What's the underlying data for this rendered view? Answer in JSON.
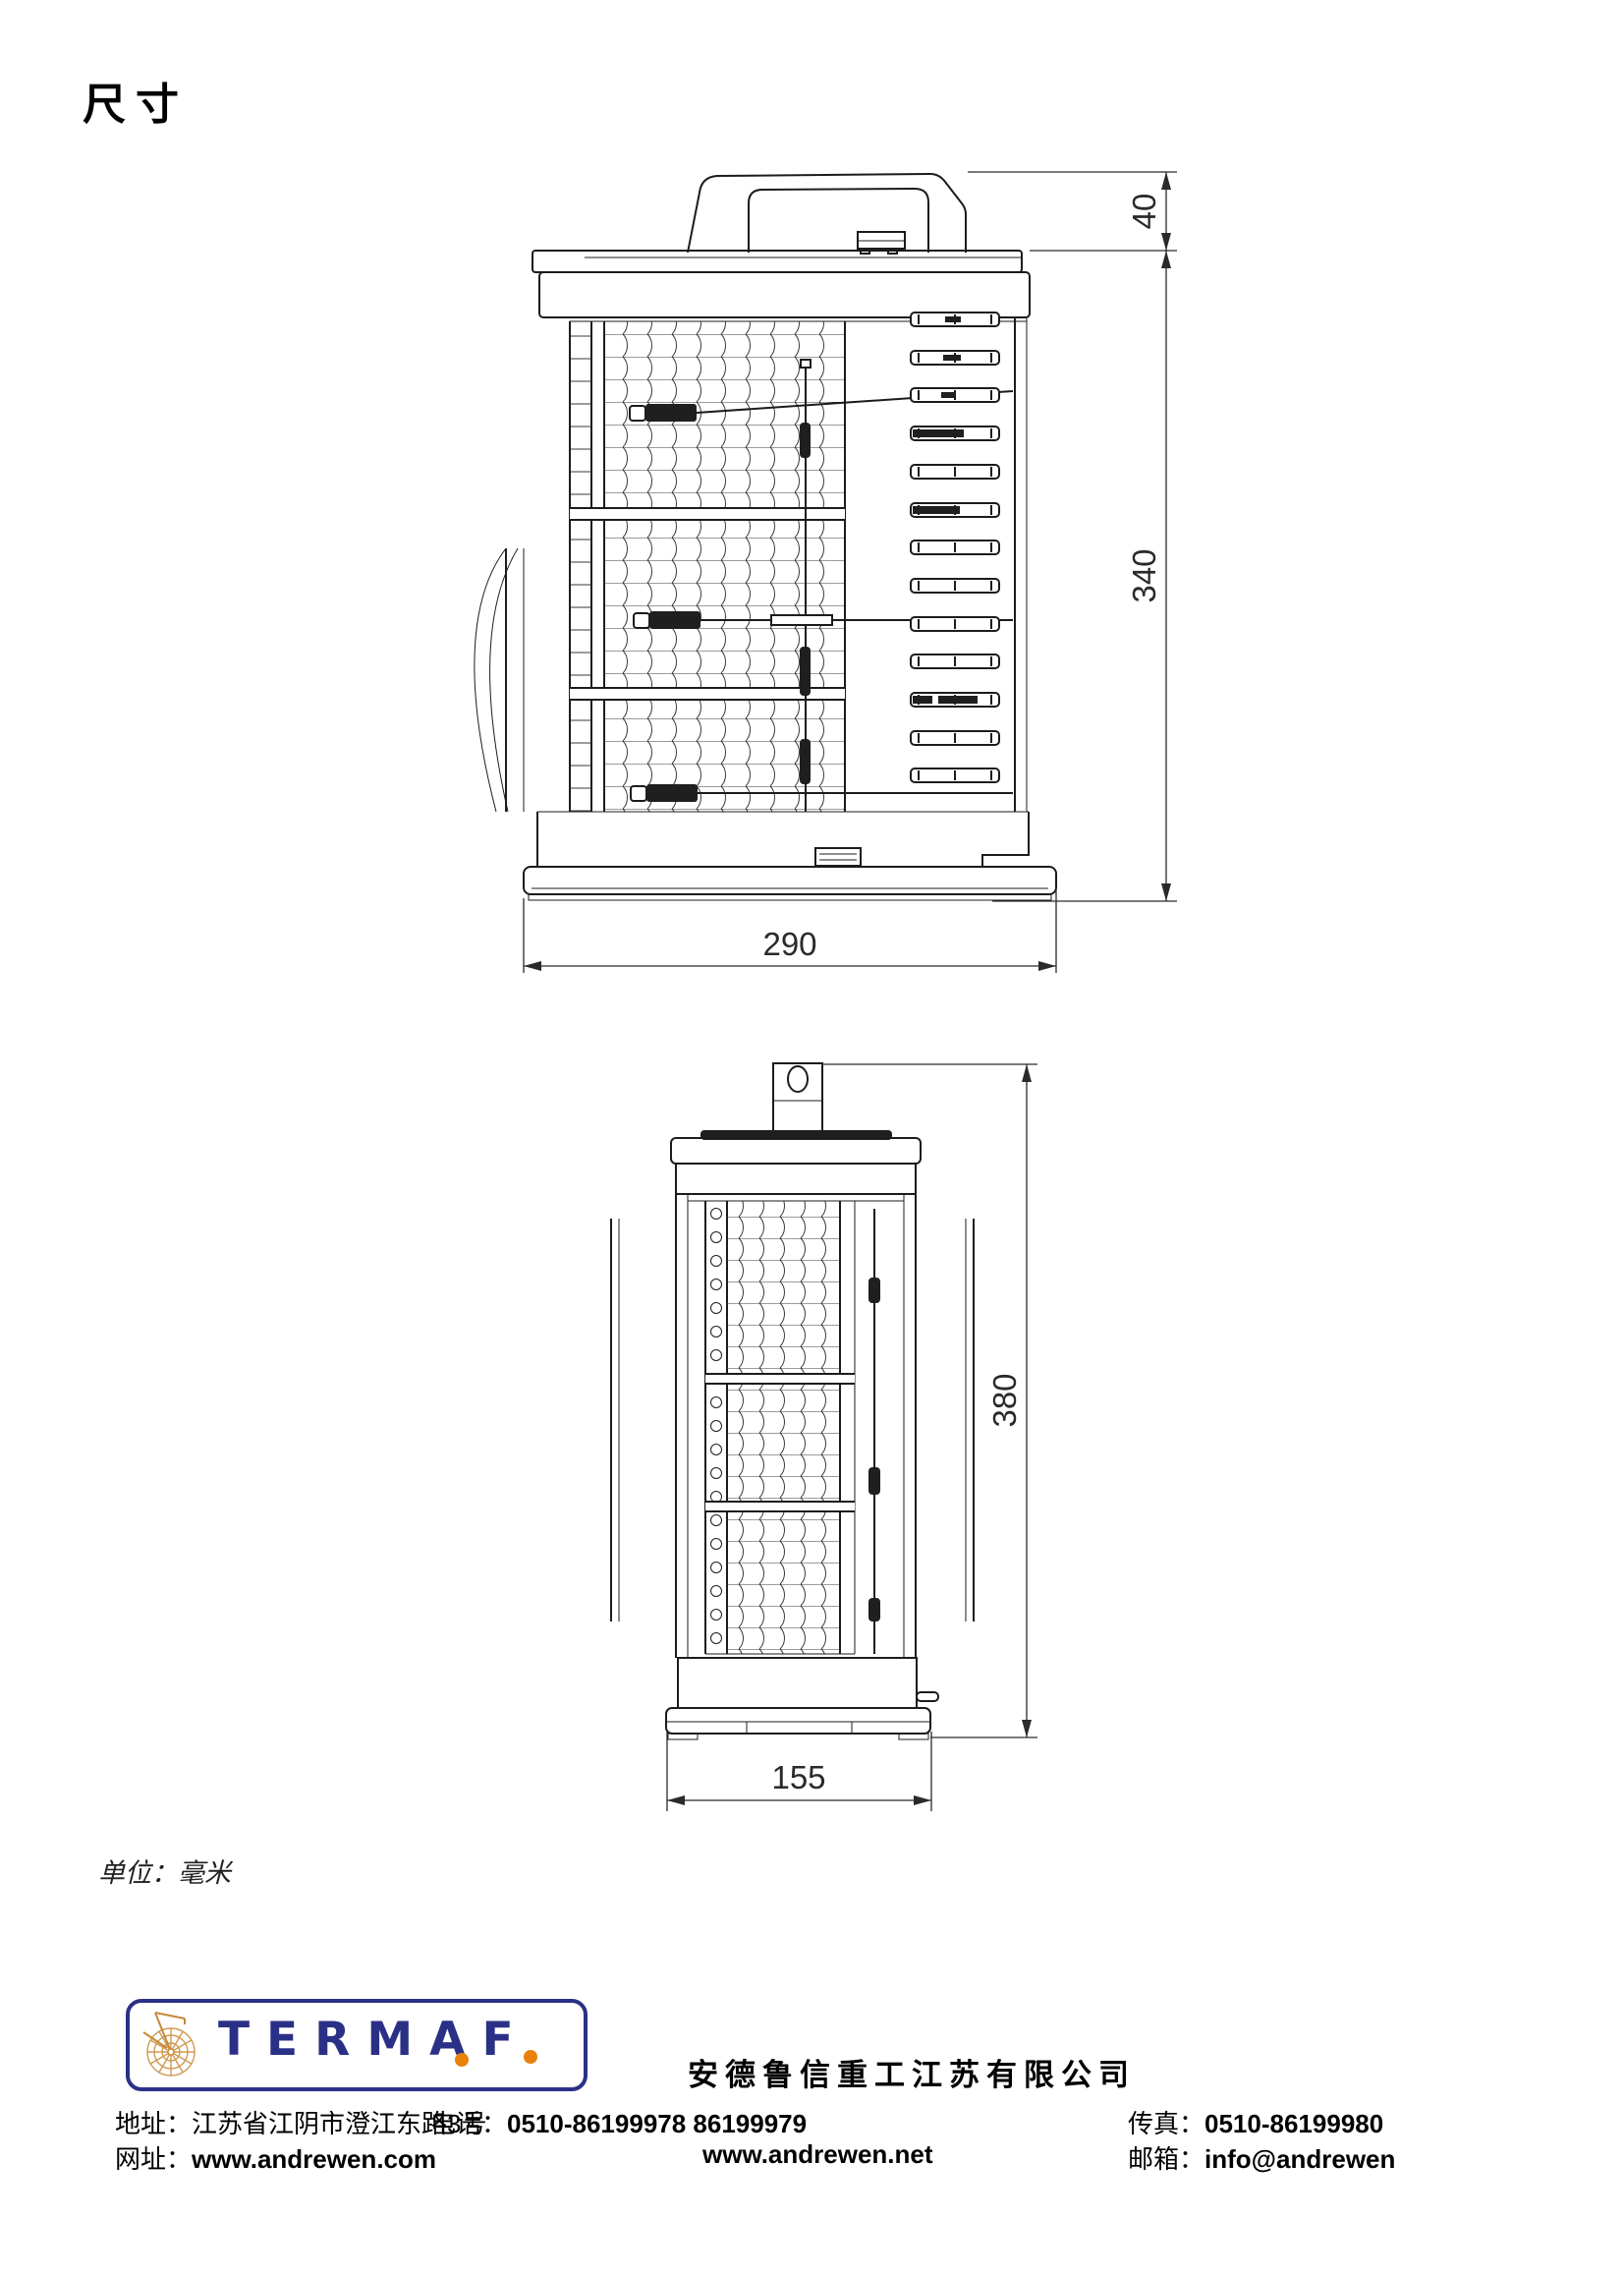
{
  "page": {
    "title": "尺寸",
    "unit_note": "单位：毫米"
  },
  "dimensions": {
    "front_view": {
      "handle_height_mm": "40",
      "body_height_mm": "340",
      "base_width_mm": "290"
    },
    "side_view": {
      "total_height_mm": "380",
      "base_depth_mm": "155"
    }
  },
  "footer": {
    "logo_text": "TERMAF",
    "company_name": "安德鲁信重工江苏有限公司",
    "address_label": "地址：",
    "address": "江苏省江阴市澄江东路3号",
    "phone_label": "电话：",
    "phone": "0510-86199978  86199979",
    "fax_label": "传真：",
    "fax": "0510-86199980",
    "web_label": "网址：",
    "web1": "www.andrewen.com",
    "web2": "www.andrewen.net",
    "mail_label": "邮箱：",
    "mail": "info@andrewen"
  },
  "colors": {
    "brand_navy": "#2b3087",
    "brand_orange": "#e8820c",
    "line_color": "#1c1c1c"
  }
}
